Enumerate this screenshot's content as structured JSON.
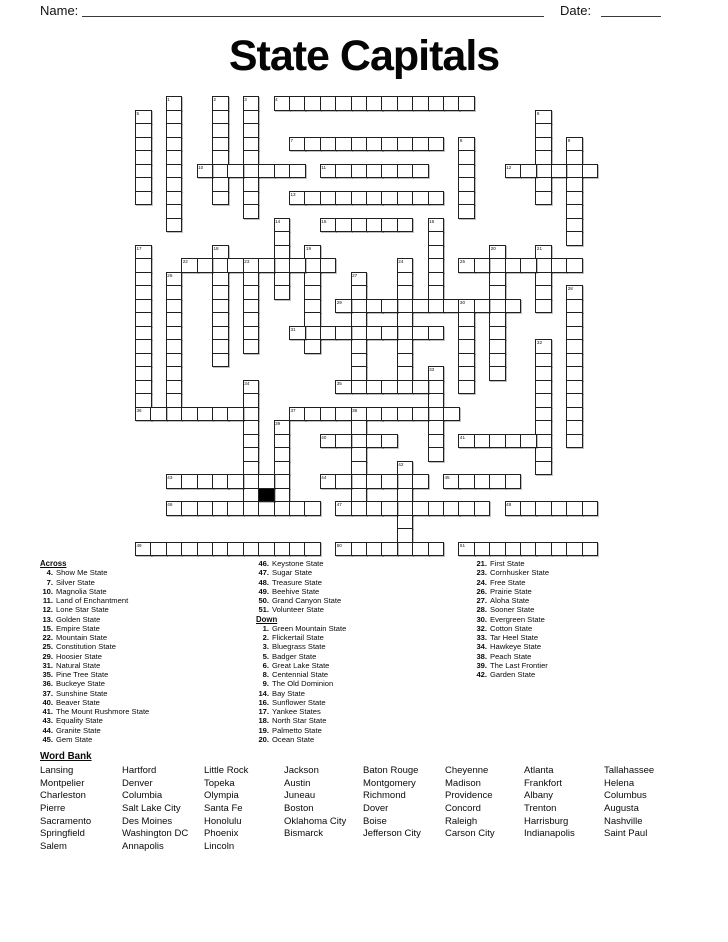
{
  "header": {
    "name_label": "Name:",
    "date_label": "Date:"
  },
  "title": "State Capitals",
  "grid": {
    "words": [
      {
        "n": 1,
        "dir": "D",
        "row": 0,
        "col": 2,
        "len": 10
      },
      {
        "n": 2,
        "dir": "D",
        "row": 0,
        "col": 5,
        "len": 8
      },
      {
        "n": 3,
        "dir": "D",
        "row": 0,
        "col": 7,
        "len": 9
      },
      {
        "n": 4,
        "dir": "A",
        "row": 0,
        "col": 9,
        "len": 13
      },
      {
        "n": 5,
        "dir": "D",
        "row": 1,
        "col": 0,
        "len": 7
      },
      {
        "n": 6,
        "dir": "D",
        "row": 1,
        "col": 26,
        "len": 7
      },
      {
        "n": 7,
        "dir": "A",
        "row": 3,
        "col": 10,
        "len": 10
      },
      {
        "n": 8,
        "dir": "D",
        "row": 3,
        "col": 21,
        "len": 6
      },
      {
        "n": 9,
        "dir": "D",
        "row": 3,
        "col": 28,
        "len": 8
      },
      {
        "n": 10,
        "dir": "A",
        "row": 5,
        "col": 4,
        "len": 7
      },
      {
        "n": 11,
        "dir": "A",
        "row": 5,
        "col": 12,
        "len": 7
      },
      {
        "n": 12,
        "dir": "A",
        "row": 5,
        "col": 24,
        "len": 6
      },
      {
        "n": 13,
        "dir": "A",
        "row": 7,
        "col": 10,
        "len": 10
      },
      {
        "n": 14,
        "dir": "D",
        "row": 9,
        "col": 9,
        "len": 6
      },
      {
        "n": 15,
        "dir": "A",
        "row": 9,
        "col": 12,
        "len": 6
      },
      {
        "n": 16,
        "dir": "D",
        "row": 9,
        "col": 19,
        "len": 6
      },
      {
        "n": 17,
        "dir": "D",
        "row": 11,
        "col": 0,
        "len": 12
      },
      {
        "n": 18,
        "dir": "D",
        "row": 11,
        "col": 5,
        "len": 9
      },
      {
        "n": 19,
        "dir": "D",
        "row": 11,
        "col": 11,
        "len": 8
      },
      {
        "n": 20,
        "dir": "D",
        "row": 11,
        "col": 23,
        "len": 10
      },
      {
        "n": 21,
        "dir": "D",
        "row": 11,
        "col": 26,
        "len": 5
      },
      {
        "n": 22,
        "dir": "A",
        "row": 12,
        "col": 3,
        "len": 10
      },
      {
        "n": 23,
        "dir": "D",
        "row": 12,
        "col": 7,
        "len": 7
      },
      {
        "n": 24,
        "dir": "D",
        "row": 12,
        "col": 17,
        "len": 9
      },
      {
        "n": 25,
        "dir": "A",
        "row": 12,
        "col": 21,
        "len": 8
      },
      {
        "n": 26,
        "dir": "D",
        "row": 13,
        "col": 2,
        "len": 11
      },
      {
        "n": 27,
        "dir": "D",
        "row": 13,
        "col": 14,
        "len": 8
      },
      {
        "n": 28,
        "dir": "D",
        "row": 14,
        "col": 28,
        "len": 12
      },
      {
        "n": 29,
        "dir": "A",
        "row": 15,
        "col": 13,
        "len": 12
      },
      {
        "n": 30,
        "dir": "D",
        "row": 15,
        "col": 21,
        "len": 7
      },
      {
        "n": 31,
        "dir": "A",
        "row": 17,
        "col": 10,
        "len": 10
      },
      {
        "n": 32,
        "dir": "D",
        "row": 18,
        "col": 26,
        "len": 10
      },
      {
        "n": 33,
        "dir": "D",
        "row": 20,
        "col": 19,
        "len": 7
      },
      {
        "n": 34,
        "dir": "D",
        "row": 21,
        "col": 7,
        "len": 9
      },
      {
        "n": 35,
        "dir": "A",
        "row": 21,
        "col": 13,
        "len": 7
      },
      {
        "n": 36,
        "dir": "A",
        "row": 23,
        "col": 0,
        "len": 8
      },
      {
        "n": 37,
        "dir": "A",
        "row": 23,
        "col": 10,
        "len": 11
      },
      {
        "n": 38,
        "dir": "D",
        "row": 23,
        "col": 14,
        "len": 7
      },
      {
        "n": 39,
        "dir": "D",
        "row": 24,
        "col": 9,
        "len": 6
      },
      {
        "n": 40,
        "dir": "A",
        "row": 25,
        "col": 12,
        "len": 5
      },
      {
        "n": 41,
        "dir": "A",
        "row": 25,
        "col": 21,
        "len": 6
      },
      {
        "n": 42,
        "dir": "D",
        "row": 27,
        "col": 17,
        "len": 7
      },
      {
        "n": 43,
        "dir": "A",
        "row": 28,
        "col": 2,
        "len": 8
      },
      {
        "n": 44,
        "dir": "A",
        "row": 28,
        "col": 12,
        "len": 7
      },
      {
        "n": 45,
        "dir": "A",
        "row": 28,
        "col": 20,
        "len": 5
      },
      {
        "n": 46,
        "dir": "A",
        "row": 30,
        "col": 2,
        "len": 10
      },
      {
        "n": 47,
        "dir": "A",
        "row": 30,
        "col": 13,
        "len": 10
      },
      {
        "n": 48,
        "dir": "A",
        "row": 30,
        "col": 24,
        "len": 6
      },
      {
        "n": 49,
        "dir": "A",
        "row": 33,
        "col": 0,
        "len": 12
      },
      {
        "n": 50,
        "dir": "A",
        "row": 33,
        "col": 13,
        "len": 7
      },
      {
        "n": 51,
        "dir": "A",
        "row": 33,
        "col": 21,
        "len": 9
      }
    ],
    "black_cells": [
      {
        "row": 29,
        "col": 8
      }
    ]
  },
  "clues": {
    "across_label": "Across",
    "down_label": "Down",
    "across": [
      {
        "n": 4,
        "text": "Show Me State"
      },
      {
        "n": 7,
        "text": "Silver State"
      },
      {
        "n": 10,
        "text": "Magnolia State"
      },
      {
        "n": 11,
        "text": "Land of Enchantment"
      },
      {
        "n": 12,
        "text": "Lone Star State"
      },
      {
        "n": 13,
        "text": "Golden State"
      },
      {
        "n": 15,
        "text": "Empire State"
      },
      {
        "n": 22,
        "text": "Mountain State"
      },
      {
        "n": 25,
        "text": "Constitution State"
      },
      {
        "n": 29,
        "text": "Hoosier State"
      },
      {
        "n": 31,
        "text": "Natural State"
      },
      {
        "n": 35,
        "text": "Pine Tree State"
      },
      {
        "n": 36,
        "text": "Buckeye State"
      },
      {
        "n": 37,
        "text": "Sunshine State"
      },
      {
        "n": 40,
        "text": "Beaver State"
      },
      {
        "n": 41,
        "text": "The Mount Rushmore State"
      },
      {
        "n": 43,
        "text": "Equality State"
      },
      {
        "n": 44,
        "text": "Granite State"
      },
      {
        "n": 45,
        "text": "Gem State"
      },
      {
        "n": 46,
        "text": "Keystone State"
      },
      {
        "n": 47,
        "text": "Sugar State"
      },
      {
        "n": 48,
        "text": "Treasure State"
      },
      {
        "n": 49,
        "text": "Beehive State"
      },
      {
        "n": 50,
        "text": "Grand Canyon State"
      },
      {
        "n": 51,
        "text": "Volunteer State"
      }
    ],
    "down": [
      {
        "n": 1,
        "text": "Green Mountain State"
      },
      {
        "n": 2,
        "text": "Flickertail State"
      },
      {
        "n": 3,
        "text": "Bluegrass State"
      },
      {
        "n": 5,
        "text": "Badger State"
      },
      {
        "n": 6,
        "text": "Great Lake State"
      },
      {
        "n": 8,
        "text": "Centennial State"
      },
      {
        "n": 9,
        "text": "The Old Dominion"
      },
      {
        "n": 14,
        "text": "Bay State"
      },
      {
        "n": 16,
        "text": "Sunflower State"
      },
      {
        "n": 17,
        "text": "Yankee States"
      },
      {
        "n": 18,
        "text": "North Star State"
      },
      {
        "n": 19,
        "text": "Palmetto State"
      },
      {
        "n": 20,
        "text": "Ocean State"
      },
      {
        "n": 21,
        "text": "First State"
      },
      {
        "n": 23,
        "text": "Cornhusker State"
      },
      {
        "n": 24,
        "text": "Free State"
      },
      {
        "n": 26,
        "text": "Prairie State"
      },
      {
        "n": 27,
        "text": "Aloha State"
      },
      {
        "n": 28,
        "text": "Sooner State"
      },
      {
        "n": 30,
        "text": "Evergreen State"
      },
      {
        "n": 32,
        "text": "Cotton State"
      },
      {
        "n": 33,
        "text": "Tar Heel State"
      },
      {
        "n": 34,
        "text": "Hawkeye State"
      },
      {
        "n": 38,
        "text": "Peach State"
      },
      {
        "n": 39,
        "text": "The Last Frontier"
      },
      {
        "n": 42,
        "text": "Garden State"
      }
    ]
  },
  "word_bank": {
    "label": "Word Bank",
    "columns": [
      [
        "Lansing",
        "Montpelier",
        "Charleston",
        "Pierre",
        "Sacramento",
        "Springfield",
        "Salem"
      ],
      [
        "Hartford",
        "Denver",
        "Columbia",
        "Salt Lake City",
        "Des Moines",
        "Washington DC",
        "Annapolis"
      ],
      [
        "Little Rock",
        "Topeka",
        "Olympia",
        "Santa Fe",
        "Honolulu",
        "Phoenix",
        "Lincoln"
      ],
      [
        "Jackson",
        "Austin",
        "Juneau",
        "Boston",
        "Oklahoma City",
        "Bismarck"
      ],
      [
        "Baton Rouge",
        "Montgomery",
        "Richmond",
        "Dover",
        "Boise",
        "Jefferson City"
      ],
      [
        "Cheyenne",
        "Madison",
        "Providence",
        "Concord",
        "Raleigh",
        "Carson City"
      ],
      [
        "Atlanta",
        "Frankfort",
        "Albany",
        "Trenton",
        "Harrisburg",
        "Indianapolis"
      ],
      [
        "Tallahassee",
        "Helena",
        "Columbus",
        "Augusta",
        "Nashville",
        "Saint Paul"
      ]
    ]
  }
}
